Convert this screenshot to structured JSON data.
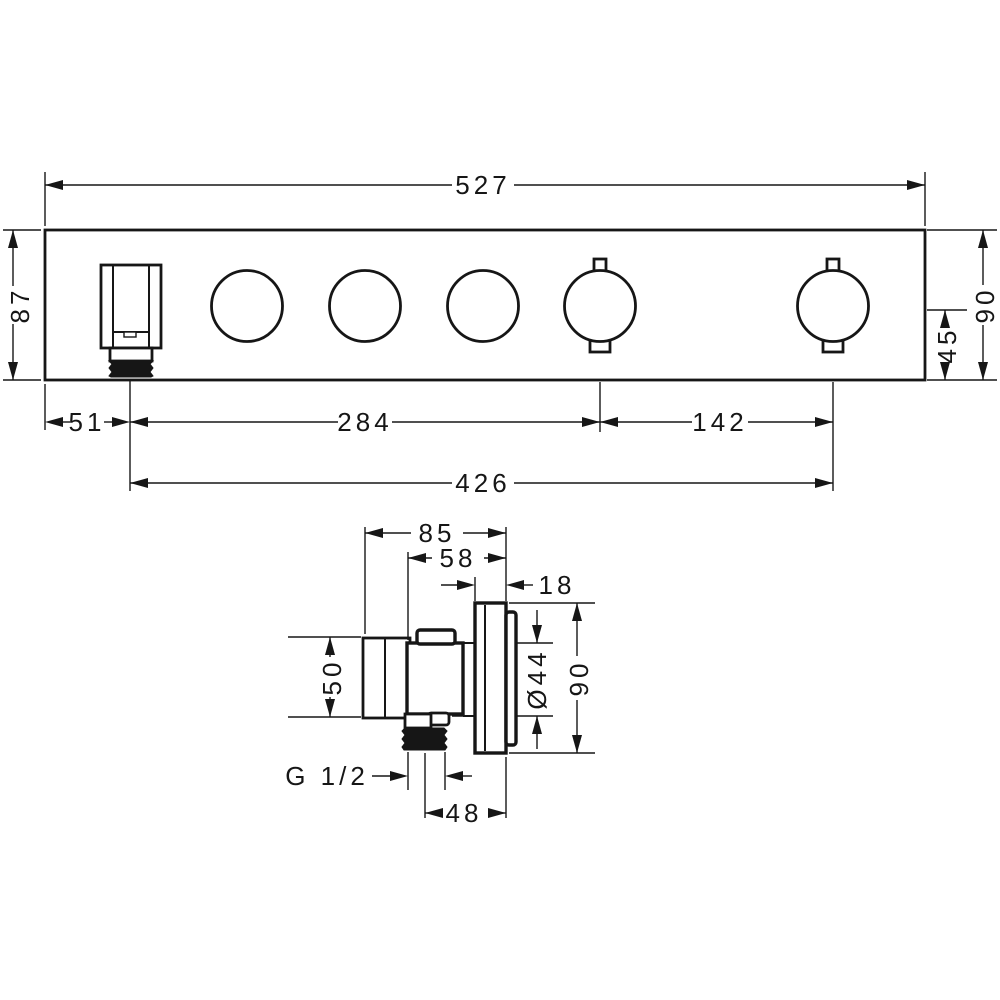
{
  "page": {
    "background": "#ffffff",
    "line_color": "#161616",
    "drawing_type": "installation-dimension-drawing"
  },
  "front_view": {
    "dims": {
      "total_width": "527",
      "height_left": "87",
      "outlet_offset": "51",
      "knob_span": "284",
      "handle_span": "142",
      "span_total": "426",
      "center_to_bottom": "45",
      "height_right": "90"
    }
  },
  "side_view": {
    "dims": {
      "depth_total": "85",
      "depth_body": "58",
      "escutcheon_depth": "18",
      "body_height": "50",
      "sleeve_diameter": "Ø44",
      "escutcheon_diameter": "90",
      "outlet_thread": "G 1/2",
      "outlet_offset": "48"
    }
  }
}
